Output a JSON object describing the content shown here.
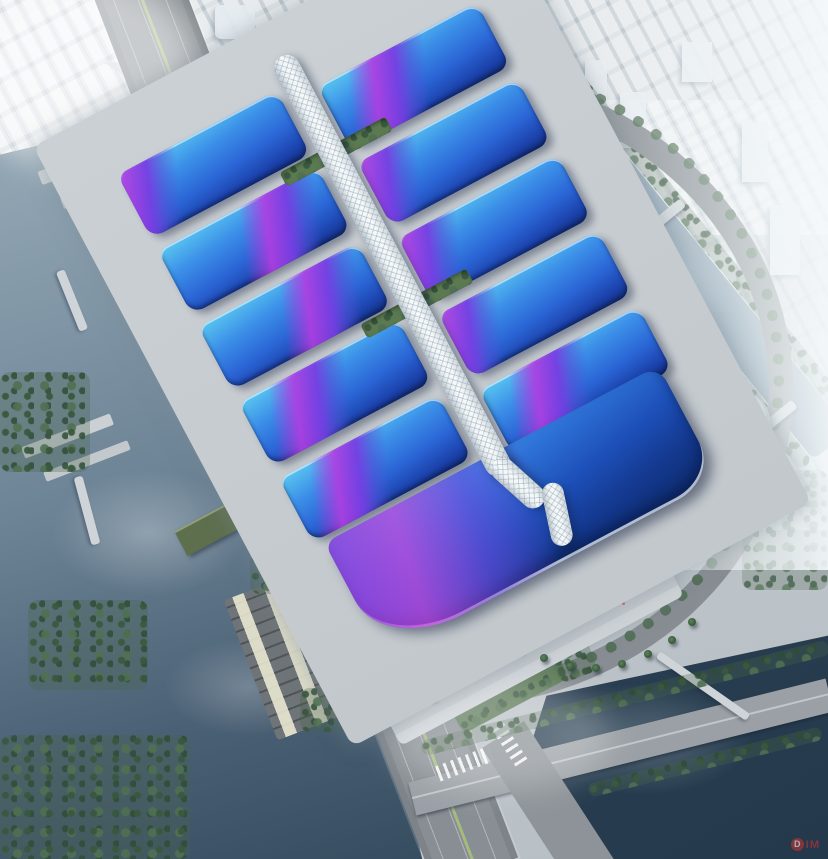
{
  "scene": {
    "type": "aerial-architectural-rendering",
    "description": "Bird's-eye rendering of a large exhibition and convention center: two columns of blue wave-roofed halls with magenta ribbon graphics flank a white serpentine central concourse; surrounded by arterial roads, canals, bus and truck marshalling lots, a south entrance plaza with palm trees, and a fog-shrouded city skyline.",
    "watermark": {
      "badge": "D",
      "text": "IM",
      "color": "#c53030"
    },
    "palette": {
      "fog_white": "#f2f6f8",
      "city_haze": "#d9e2e8",
      "ground_gray": "#bfc6cb",
      "road_gray": "#83898e",
      "plaza_gray": "#ccd1d5",
      "water_light": "#8ba1b0",
      "water_dark": "#2c4254",
      "tree_green": "#4c6b4e",
      "warehouse_green": "#5e6f4e",
      "roof_cyan": "#59c6f0",
      "roof_blue": "#2b66d6",
      "roof_deep_blue": "#13307e",
      "ribbon_magenta": "#b03ee2",
      "ribbon_purple": "#7640e2",
      "spine_white": "#eef3f5",
      "accent_red": "#d03030"
    },
    "complex": {
      "hall_rows": 5,
      "wings_per_row": 2,
      "spine": "white lattice serpentine concourse",
      "lobby": "south entrance hall with wave-form roof and purple-magenta gradient",
      "courtyards": 2
    },
    "surroundings": {
      "west": "multi-lane arterial road, river with terraced embankments, bus and truck lots, green-roofed warehouses",
      "east": "curving boulevard with tree median, canal with bridges, round towers, spiral-form pavilion",
      "south": "striped pedestrian plaza, palm trees, red art installation, road intersection and dark pond",
      "north": "truck marshalling apron and fog-covered city skyline with domed buildings"
    }
  }
}
